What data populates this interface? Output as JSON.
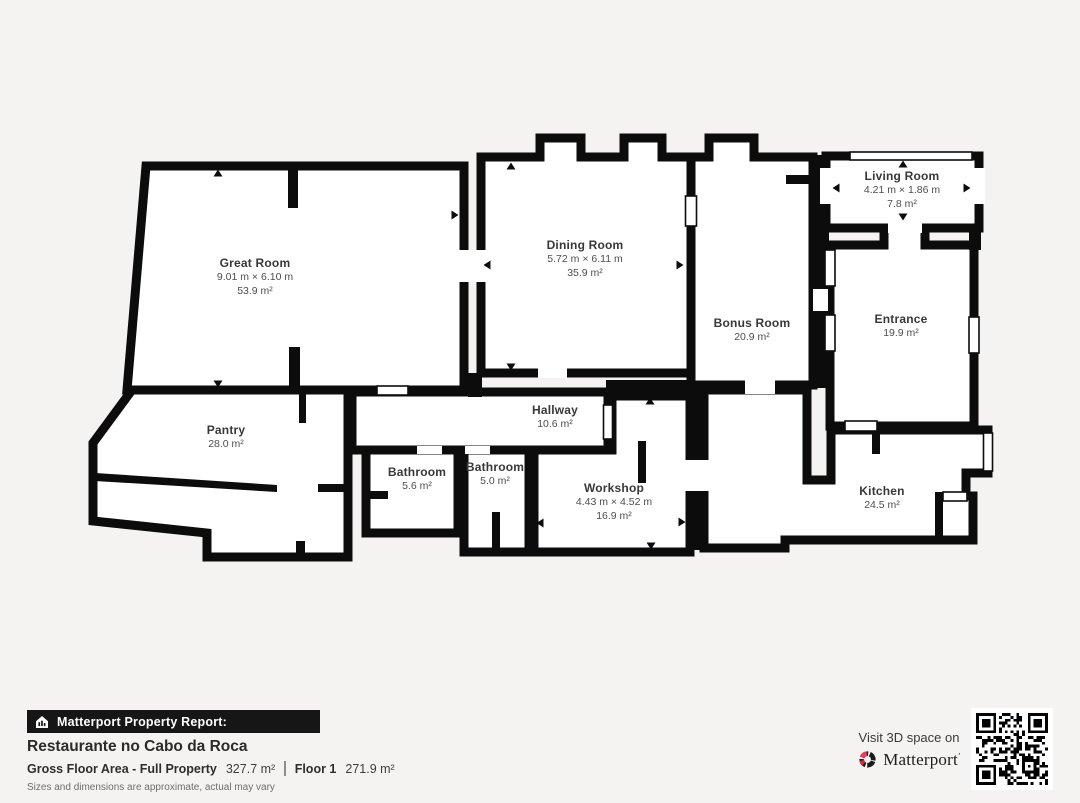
{
  "floor_plan": {
    "floor_name": "Floor 1",
    "rooms": [
      {
        "name": "Great Room",
        "dims": "9.01 m × 6.10 m",
        "area": "53.9 m²",
        "cx": 255,
        "cy": 257
      },
      {
        "name": "Dining Room",
        "dims": "5.72 m × 6.11 m",
        "area": "35.9 m²",
        "cx": 585,
        "cy": 239
      },
      {
        "name": "Bonus Room",
        "dims": null,
        "area": "20.9 m²",
        "cx": 752,
        "cy": 317
      },
      {
        "name": "Living Room",
        "dims": "4.21 m × 1.86 m",
        "area": "7.8 m²",
        "cx": 902,
        "cy": 170
      },
      {
        "name": "Entrance",
        "dims": null,
        "area": "19.9 m²",
        "cx": 901,
        "cy": 313
      },
      {
        "name": "Pantry",
        "dims": null,
        "area": "28.0 m²",
        "cx": 226,
        "cy": 424
      },
      {
        "name": "Hallway",
        "dims": null,
        "area": "10.6 m²",
        "cx": 555,
        "cy": 404
      },
      {
        "name": "Bathroom",
        "dims": null,
        "area": "5.6 m²",
        "cx": 417,
        "cy": 466
      },
      {
        "name": "Bathroom",
        "dims": null,
        "area": "5.0 m²",
        "cx": 495,
        "cy": 461
      },
      {
        "name": "Workshop",
        "dims": "4.43 m × 4.52 m",
        "area": "16.9 m²",
        "cx": 614,
        "cy": 482
      },
      {
        "name": "Kitchen",
        "dims": null,
        "area": "24.5 m²",
        "cx": 882,
        "cy": 485
      }
    ]
  },
  "footer": {
    "report_label": "Matterport Property Report:",
    "property_name": "Restaurante no Cabo da Roca",
    "gross_label": "Gross Floor Area - Full Property",
    "gross_value": "327.7 m²",
    "floor_label": "Floor 1",
    "floor_value": "271.9 m²",
    "disclaimer": "Sizes and dimensions are approximate, actual may vary"
  },
  "cta": {
    "visit_text": "Visit 3D space on",
    "brand": "Matterport"
  },
  "icons": {
    "report_bar": "house-chart-icon",
    "brand_mark": "matterport-logo",
    "qr": "qr-code"
  },
  "colors": {
    "background": "#f4f3f1",
    "wall": "#0c0c0c",
    "room_fill": "#ffffff",
    "bar_bg": "#161616",
    "brand_pink": "#f5365c",
    "brand_red": "#d62839"
  }
}
